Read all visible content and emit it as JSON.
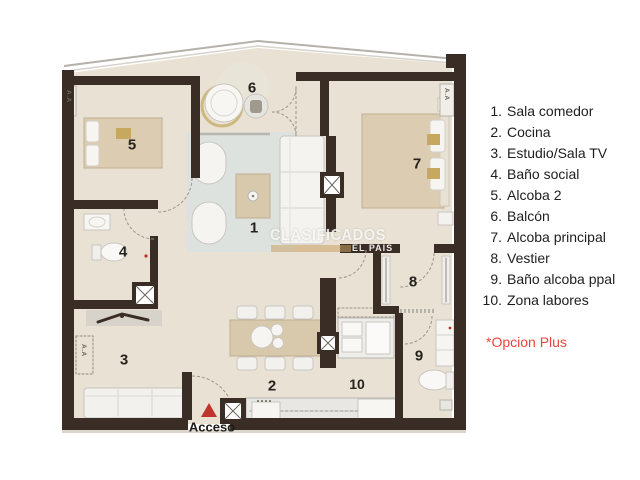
{
  "legend": {
    "items": [
      {
        "number": "1.",
        "label": "Sala comedor"
      },
      {
        "number": "2.",
        "label": "Cocina"
      },
      {
        "number": "3.",
        "label": "Estudio/Sala TV"
      },
      {
        "number": "4.",
        "label": "Baño social"
      },
      {
        "number": "5.",
        "label": "Alcoba 2"
      },
      {
        "number": "6.",
        "label": "Balcón"
      },
      {
        "number": "7.",
        "label": "Alcoba principal"
      },
      {
        "number": "8.",
        "label": "Vestier"
      },
      {
        "number": "9.",
        "label": "Baño alcoba ppal"
      },
      {
        "number": "10.",
        "label": "Zona labores"
      }
    ],
    "note": "*Opcion Plus"
  },
  "plan": {
    "labels": [
      "1",
      "2",
      "3",
      "4",
      "5",
      "6",
      "7",
      "8",
      "9",
      "10"
    ],
    "access_label": "Acceso",
    "ac_label": "A.A",
    "watermark": {
      "line1": "CLASIFICADOS",
      "line2": "EL PAIS"
    }
  },
  "colors": {
    "walls": "#3a2d25",
    "floor": "#e9e1d3",
    "rug": "#dde2df",
    "wood": "#d9c9ac",
    "accent_red": "#e8463c",
    "triangle_red": "#c0342e"
  }
}
